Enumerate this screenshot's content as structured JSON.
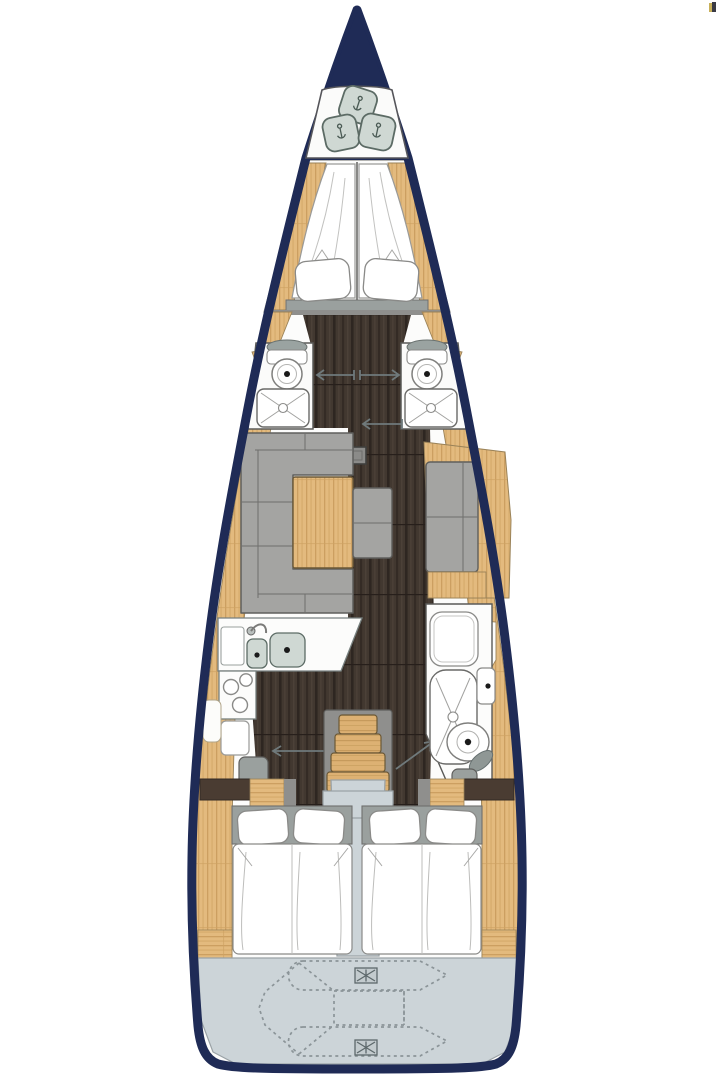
{
  "plan": {
    "type": "sailing-yacht-interior-floor-plan",
    "view": "top-down",
    "areas": [
      "bow",
      "anchor-locker",
      "forward-cabin",
      "port-head",
      "starboard-head",
      "saloon",
      "galley",
      "aft-head",
      "companionway",
      "engine-compartment",
      "port-aft-cabin",
      "starboard-aft-cabin",
      "swim-platform-with-dinghy"
    ]
  },
  "icons": {
    "anchor_hatch": "rounded-square-latch",
    "toilet": "bowl-with-drain-dot",
    "shower_tray": "rounded-pan-with-cross",
    "sink": "basin-with-drain-dot",
    "faucet": "swan-neck",
    "stove": "three-burner-rings",
    "mast_step": "gray-square",
    "door_slide": "arrow-line",
    "stairs": "companionway-steps",
    "dinghy": "dashed-tender-outline",
    "deck_hatch": "crossed-rectangle"
  },
  "colors": {
    "hull": "#1f2b56",
    "wood": "#e3ba7e",
    "wood_grain": "#c89a5c",
    "floor_dark": "#423830",
    "cushion": "#a4a4a2",
    "board_gray": "#9aa09e",
    "frame_gray": "#8f8f8d",
    "hatch_sage": "#cfd8d3",
    "pale_blue": "#ccd4d8",
    "white": "#fcfcfb",
    "outline": "#5a5a58",
    "door_line": "#6f797b",
    "background": "#ffffff"
  }
}
